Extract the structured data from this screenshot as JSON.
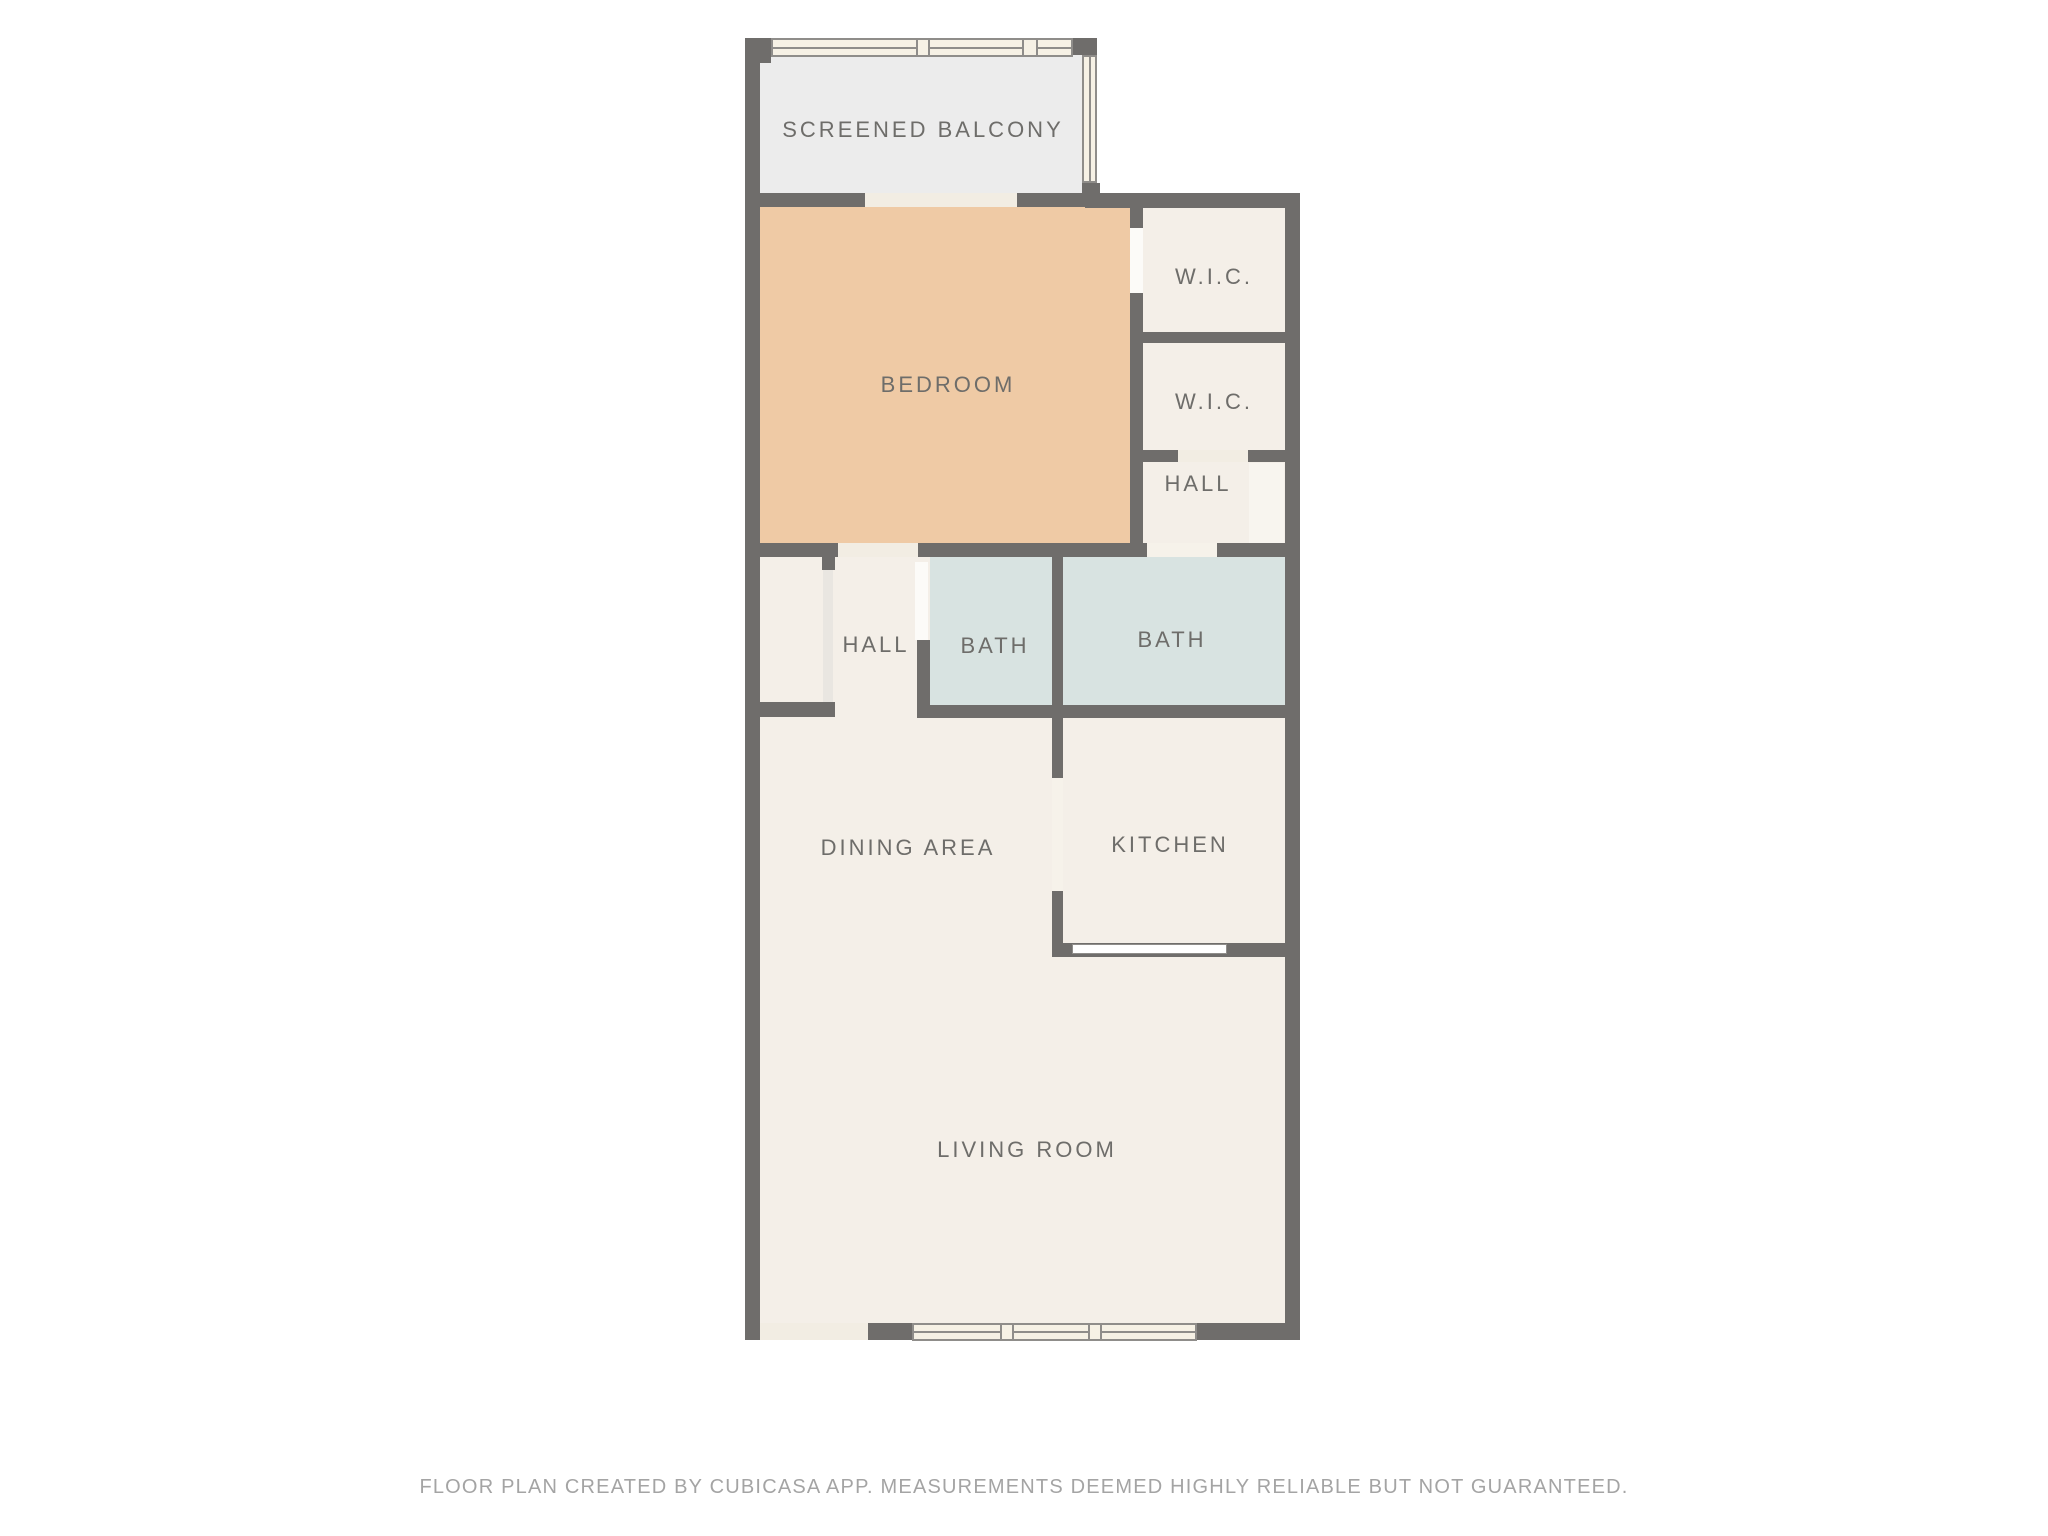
{
  "floor_plan": {
    "title": "Apartment floor plan",
    "rooms": [
      {
        "id": "screened-balcony",
        "label": "SCREENED BALCONY",
        "fill": "#ececec"
      },
      {
        "id": "bedroom",
        "label": "BEDROOM",
        "fill": "#efcaa5"
      },
      {
        "id": "wic-1",
        "label": "W.I.C.",
        "fill": "#f4efe8"
      },
      {
        "id": "wic-2",
        "label": "W.I.C.",
        "fill": "#f4efe8"
      },
      {
        "id": "hall-upper",
        "label": "HALL",
        "fill": "#f4efe8"
      },
      {
        "id": "hall-lower",
        "label": "HALL",
        "fill": "#f4efe8"
      },
      {
        "id": "bath-1",
        "label": "BATH",
        "fill": "#d8e3e1"
      },
      {
        "id": "bath-2",
        "label": "BATH",
        "fill": "#d8e3e1"
      },
      {
        "id": "dining-area",
        "label": "DINING AREA",
        "fill": "#f4efe8"
      },
      {
        "id": "kitchen",
        "label": "KITCHEN",
        "fill": "#f4efe8"
      },
      {
        "id": "living-room",
        "label": "LIVING ROOM",
        "fill": "#f4efe8"
      }
    ],
    "colors": {
      "wall": "#6f6d6b",
      "room_cream": "#f4efe8",
      "bedroom_peach": "#efcaa5",
      "bath_blue": "#d8e3e1",
      "balcony_gray": "#ececec",
      "window_fill": "#f6f1e5",
      "window_line": "#8f8d8a",
      "label_text": "#6e6d6a",
      "footer_text": "#a4a4a4",
      "background": "#ffffff"
    },
    "footer": "FLOOR PLAN CREATED BY CUBICASA APP. MEASUREMENTS DEEMED HIGHLY RELIABLE BUT NOT GUARANTEED."
  }
}
